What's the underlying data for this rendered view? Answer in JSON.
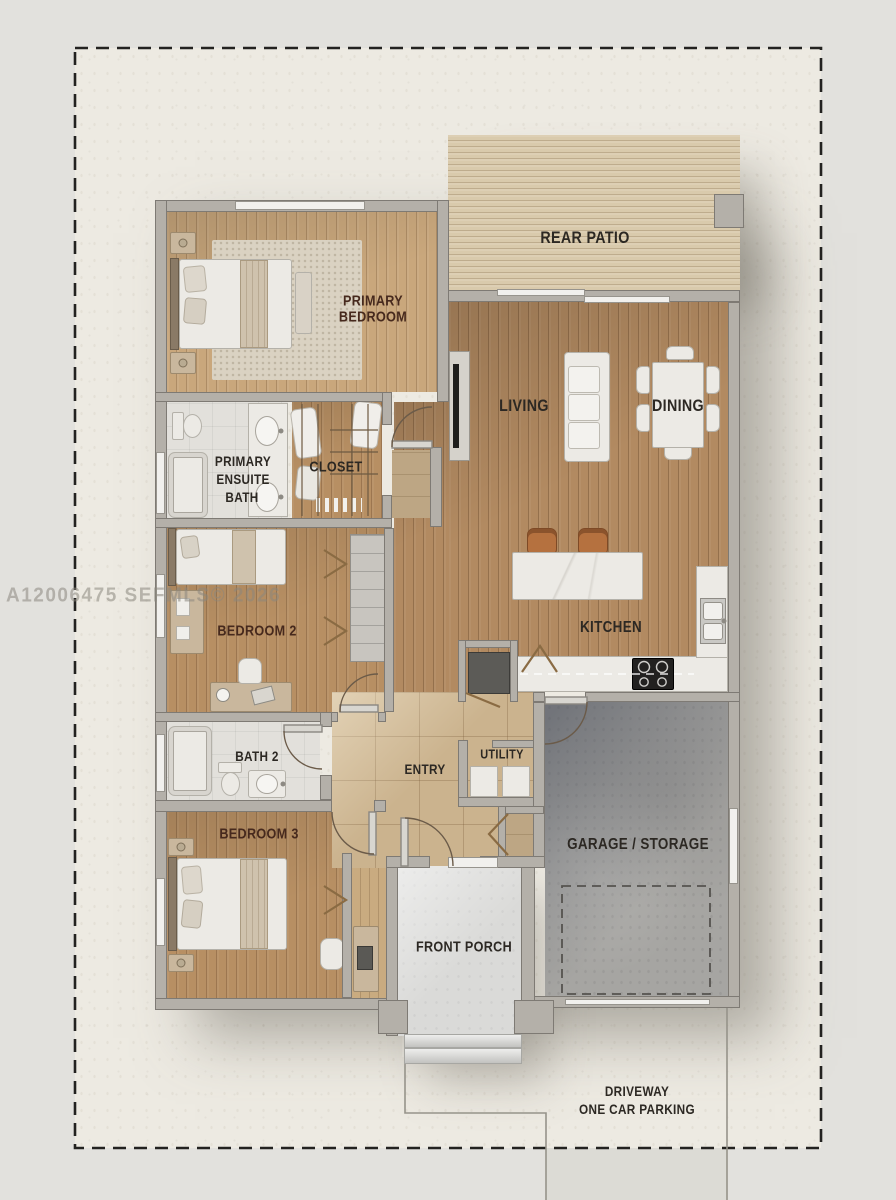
{
  "watermark": "A12006475 SEFMLS© 2026",
  "palette": {
    "bg_outer": "#e2e1dd",
    "bg_property": "#edeae2",
    "wall_fill": "#b4b0a9",
    "wall_edge": "#7e7a74",
    "garage_floor": "#a6a5a2",
    "porch_floor": "#dadad8",
    "furniture_white": "#eceae5",
    "furniture_tan": "#c9b79d",
    "stool_orange": "#b5713f",
    "label_dark": "#2c2823",
    "label_maroon": "#46291d"
  },
  "labels": {
    "rear_patio": "REAR PATIO",
    "primary_bedroom_l1": "PRIMARY",
    "primary_bedroom_l2": "BEDROOM",
    "living": "LIVING",
    "dining": "DINING",
    "ensuite_l1": "PRIMARY",
    "ensuite_l2": "ENSUITE",
    "ensuite_l3": "BATH",
    "closet": "CLOSET",
    "bedroom2": "BEDROOM 2",
    "kitchen": "KITCHEN",
    "bath2": "BATH 2",
    "entry": "ENTRY",
    "utility": "UTILITY",
    "bedroom3": "BEDROOM 3",
    "garage": "GARAGE / STORAGE",
    "front_porch": "FRONT PORCH",
    "driveway_l1": "DRIVEWAY",
    "driveway_l2": "ONE CAR PARKING"
  }
}
